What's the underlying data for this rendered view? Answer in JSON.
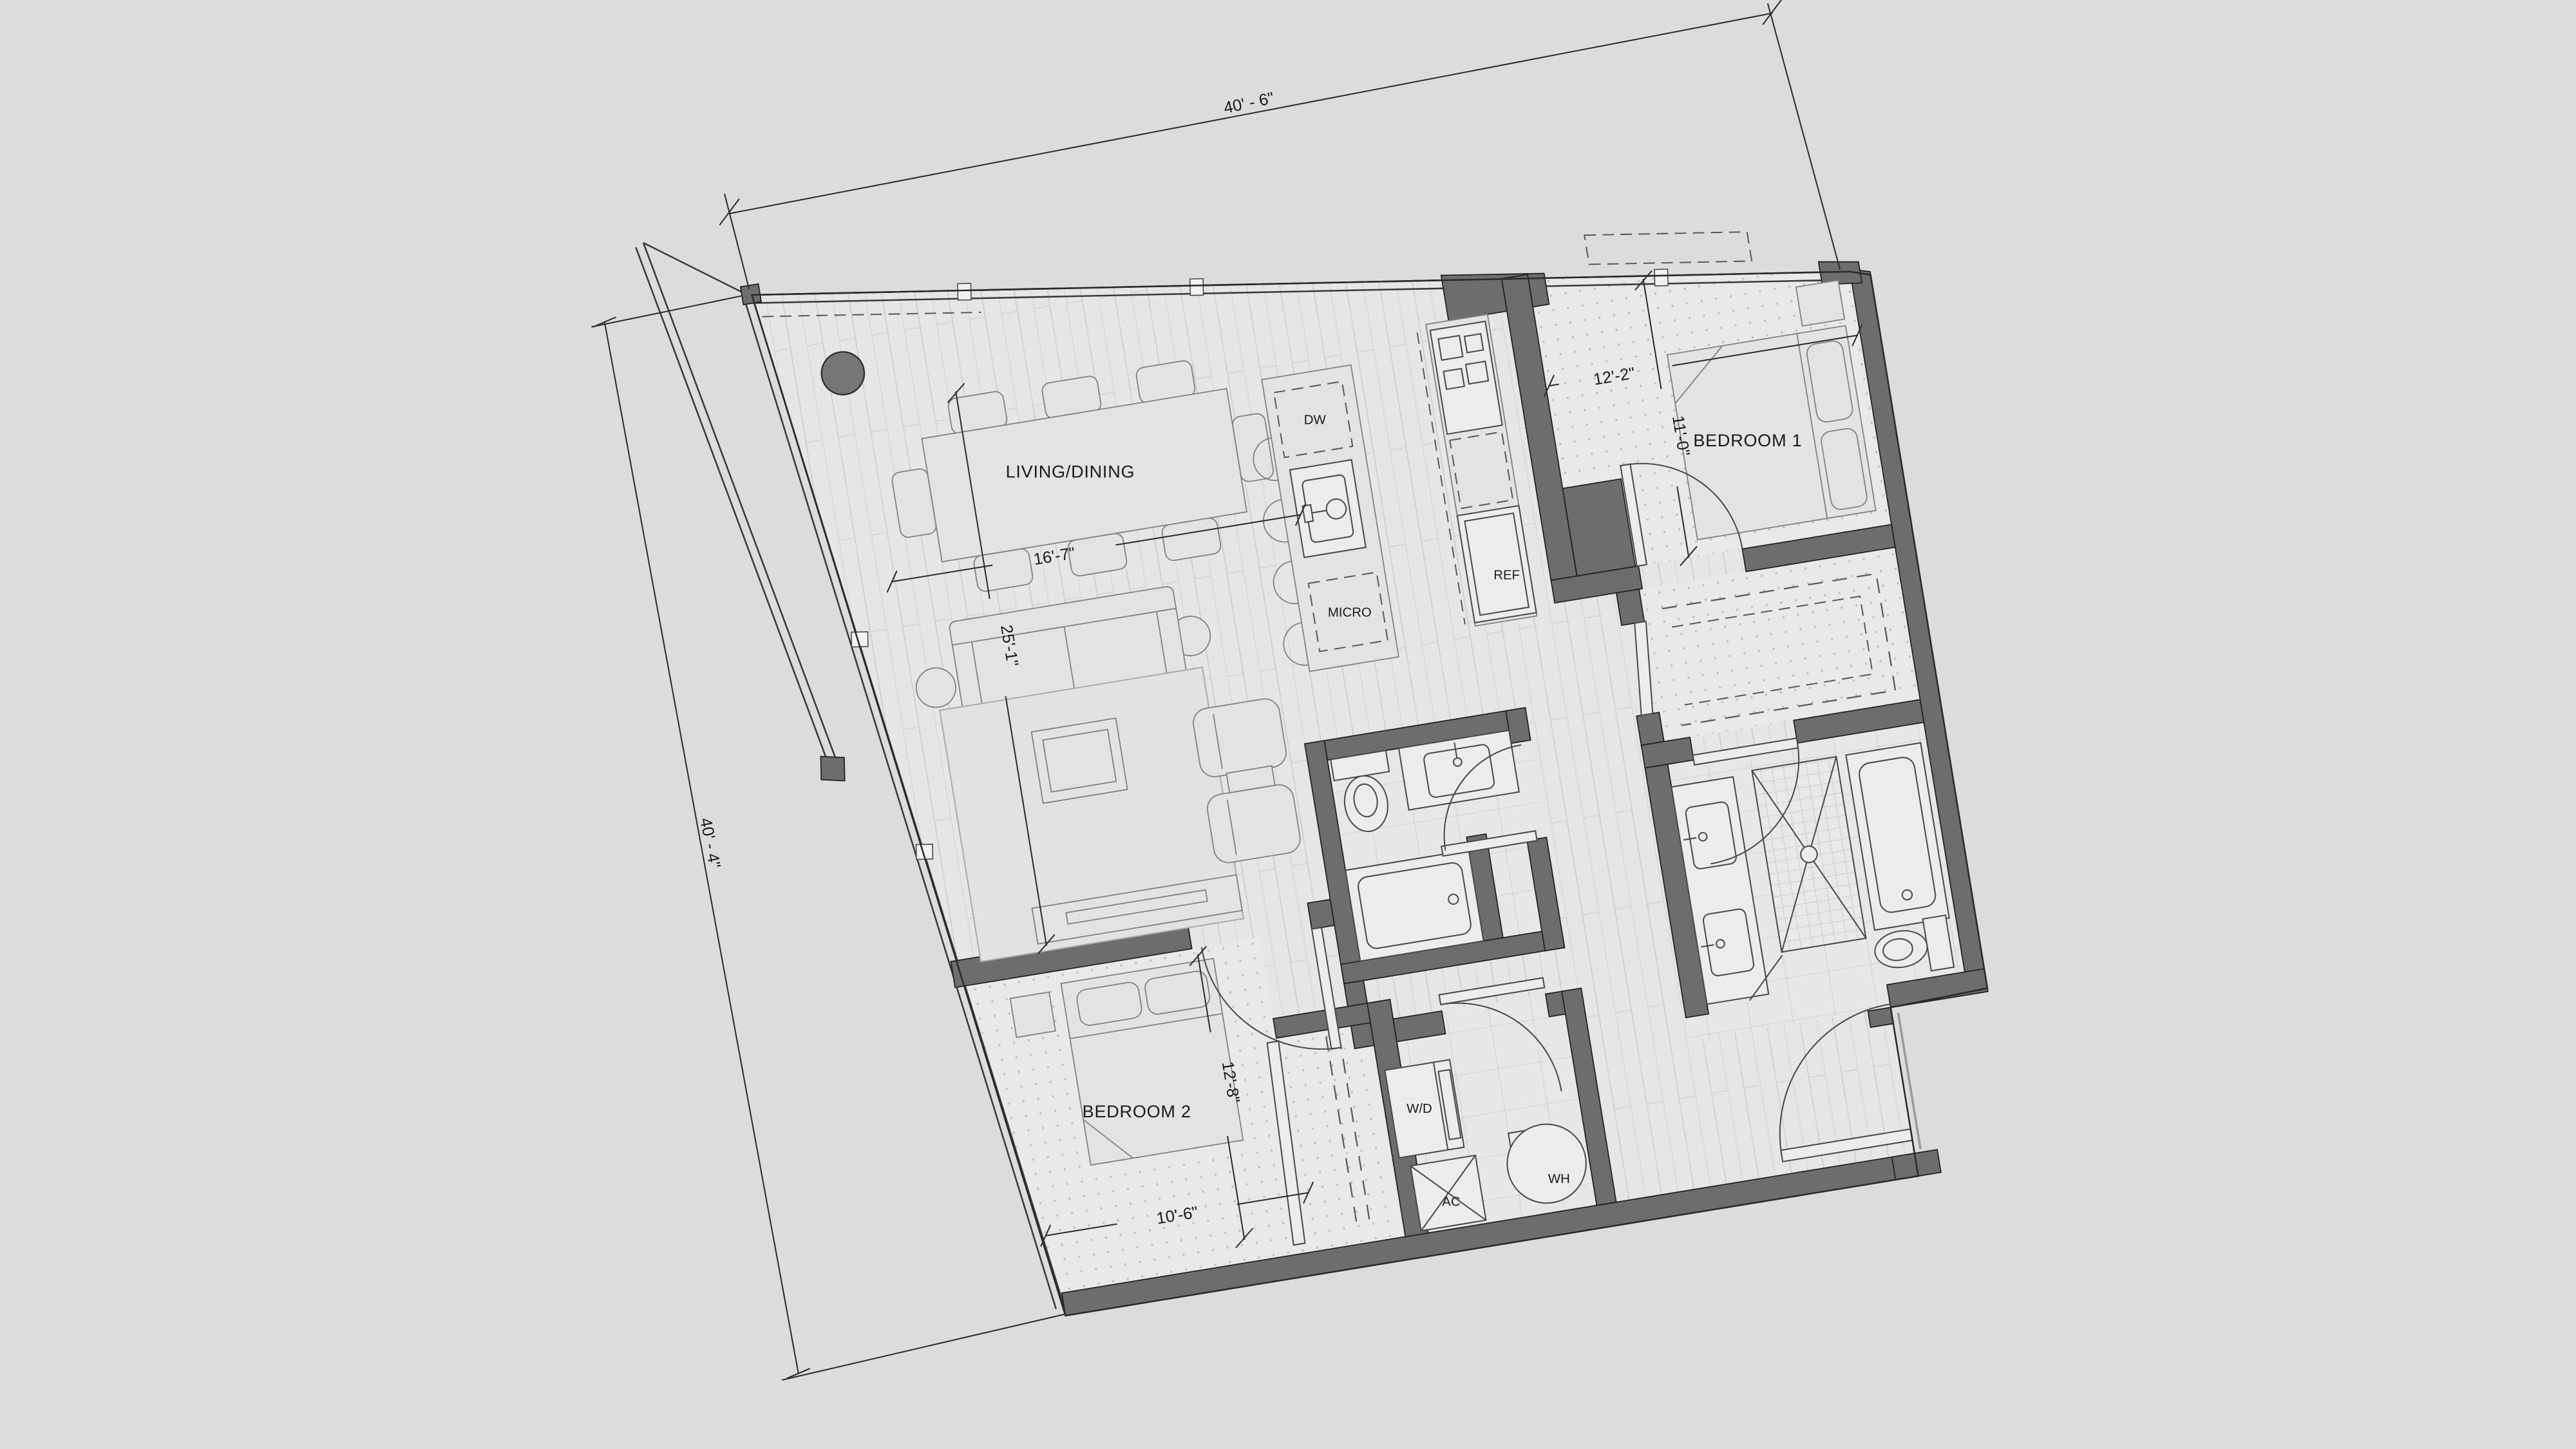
{
  "floor_plan": {
    "type": "apartment-unit-plan",
    "rooms": {
      "living_dining": "LIVING/DINING",
      "bedroom1": "BEDROOM 1",
      "bedroom2": "BEDROOM 2"
    },
    "appliances": {
      "dishwasher": "DW",
      "microwave": "MICRO",
      "refrigerator": "REF",
      "washer_dryer": "W/D",
      "air_conditioner": "AC",
      "water_heater": "WH"
    },
    "dimensions": {
      "overall_top": "40' - 6\"",
      "overall_left": "40' - 4\"",
      "bedroom1_width": "12'-2\"",
      "bedroom1_depth": "11'-0\"",
      "living_width": "16'-7\"",
      "living_length": "25'-1\"",
      "bedroom2_depth": "12'-8\"",
      "bedroom2_width": "10'-6\""
    },
    "colors": {
      "background": "#dcdcdc",
      "walls": "#6d6d6d",
      "lines": "#333333",
      "text": "#1a1a1a",
      "wood_floor": "#e6e6e6",
      "carpet_floor": "#e9e9e9",
      "column": "#767676"
    }
  }
}
